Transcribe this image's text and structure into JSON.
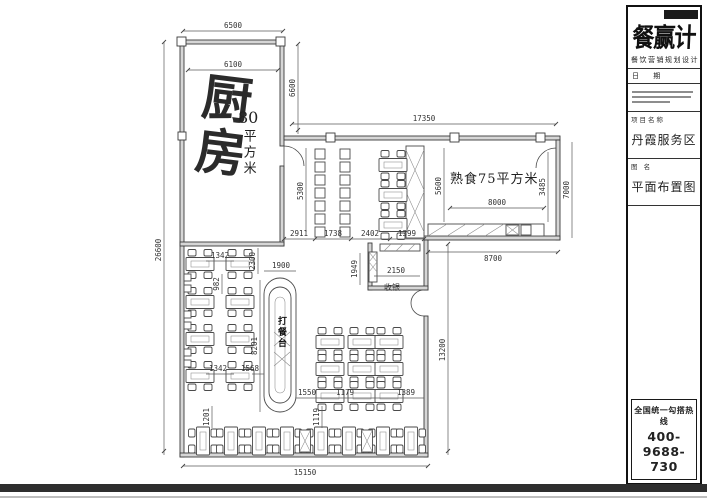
{
  "title_block": {
    "logo": "餐赢计",
    "tagline": "餐饮营销规划设计",
    "date_label": "日 期",
    "project_label": "项目名称",
    "project_name": "丹霞服务区",
    "drawing_label": "图 名",
    "drawing_name": "平面布置图",
    "hotline_label": "全国统一勾搭热线",
    "hotline_number": "400-9688-730"
  },
  "plan": {
    "rooms": {
      "kitchen_name": "厨房",
      "kitchen_area_number": "80",
      "kitchen_area_unit": "平方米",
      "cooked_food_label": "熟食75平方米",
      "serving_island_label": "打餐台",
      "cashier_label": "收银"
    },
    "dims": {
      "top_outer": "6500",
      "top_inner": "6100",
      "kitchen_right": "6600",
      "overall_left": "26600",
      "corridor_top": "17350",
      "corridor_left": "5300",
      "seg_2911": "2911",
      "seg_1738": "1738",
      "seg_2402": "2402",
      "seg_1399": "1399",
      "cooked_left": "5600",
      "cooked_inner": "8000",
      "cooked_right_inner": "3485",
      "cooked_right_outer": "7000",
      "cooked_bottom": "8700",
      "cashier_height": "1949",
      "cashier_width": "2150",
      "dining_right": "13200",
      "island_offset": "2300",
      "island_width": "1900",
      "island_height": "8201",
      "left_gap_a": "1342",
      "left_gap_b": "1342",
      "row_gap": "982",
      "to_island": "1568",
      "mid_a": "1550",
      "mid_b": "1179",
      "mid_c": "1389",
      "bottom_a": "1201",
      "bottom_b": "1119",
      "bottom_total": "15150"
    }
  },
  "colors": {
    "line": "#444444",
    "panel_border": "#111111",
    "bottom_band": "#2e2e2e"
  }
}
